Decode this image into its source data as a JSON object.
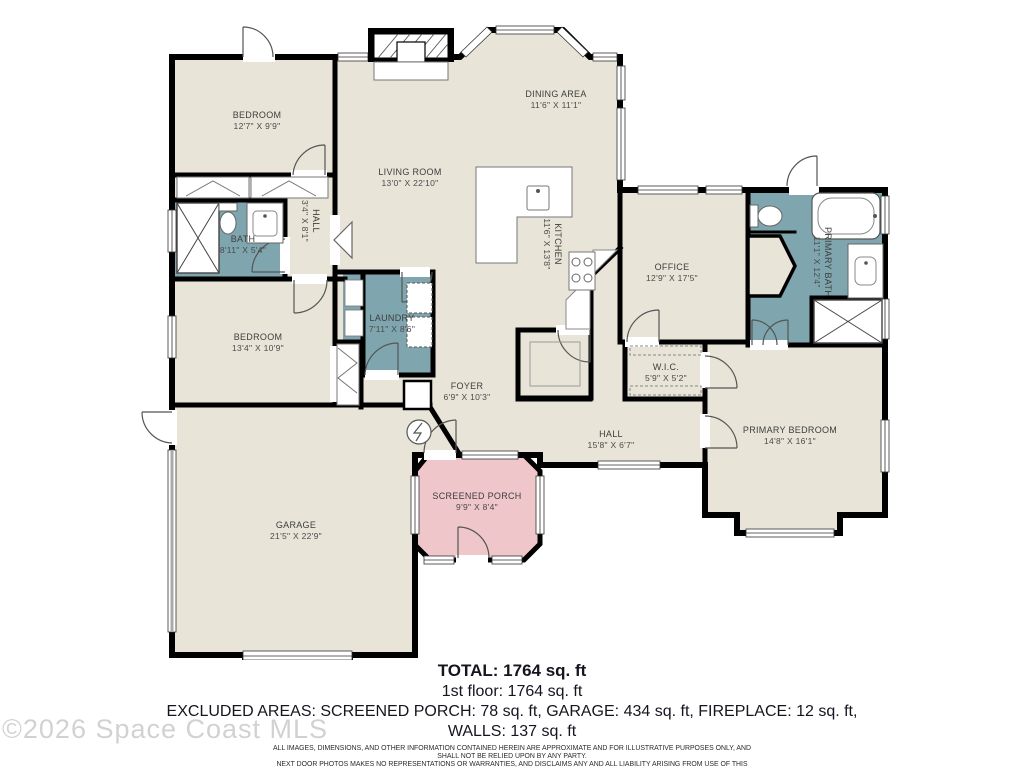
{
  "plan": {
    "colors": {
      "floor": "#e8e5d8",
      "wet_room": "#7fa6ae",
      "porch": "#efc6ca",
      "wall": "#000000",
      "label_text": "#3d3d3d"
    },
    "rooms": [
      {
        "name": "BEDROOM",
        "dims": "12'7\" X 9'9\""
      },
      {
        "name": "DINING AREA",
        "dims": "11'6\" X 11'1\""
      },
      {
        "name": "LIVING ROOM",
        "dims": "13'0\" X 22'10\""
      },
      {
        "name": "KITCHEN",
        "dims": "11'6\" X 13'8\""
      },
      {
        "name": "OFFICE",
        "dims": "12'9\" X 17'5\""
      },
      {
        "name": "PRIMARY BATH",
        "dims": "11'1\" X 12'4\""
      },
      {
        "name": "HALL",
        "dims": "3'4\" X 8'1\""
      },
      {
        "name": "BATH",
        "dims": "8'11\" X 5'4\""
      },
      {
        "name": "BEDROOM",
        "dims": "13'4\" X 10'9\""
      },
      {
        "name": "LAUNDRY",
        "dims": "7'11\" X 8'6\""
      },
      {
        "name": "FOYER",
        "dims": "6'9\" X 10'3\""
      },
      {
        "name": "W.I.C.",
        "dims": "5'9\" X 5'2\""
      },
      {
        "name": "HALL",
        "dims": "15'8\" X 6'7\""
      },
      {
        "name": "PRIMARY BEDROOM",
        "dims": "14'8\" X 16'1\""
      },
      {
        "name": "GARAGE",
        "dims": "21'5\" X 22'9\""
      },
      {
        "name": "SCREENED PORCH",
        "dims": "9'9\" X 8'4\""
      }
    ]
  },
  "summary": {
    "total_line": "TOTAL: 1764 sq. ft",
    "floor_line": "1st floor: 1764 sq. ft",
    "excluded_line": "EXCLUDED AREAS: SCREENED PORCH: 78 sq. ft, GARAGE: 434 sq. ft, FIREPLACE: 12 sq. ft,",
    "walls_line": "WALLS: 137 sq. ft",
    "disclaimer_lines": [
      "ALL IMAGES, DIMENSIONS, AND OTHER INFORMATION CONTAINED HEREIN ARE APPROXIMATE AND FOR ILLUSTRATIVE PURPOSES ONLY, AND SHALL NOT BE RELIED UPON BY ANY PARTY.",
      "NEXT DOOR PHOTOS MAKES NO REPRESENTATIONS OR WARRANTIES, AND DISCLAIMS ANY AND ALL LIABILITY ARISING FROM USE OF THIS INFORMATION. ALL INFORMATION HEREIN",
      "SHALL BE SUBJECT TO THE TERMS AND CONDITIONS FOUND AT NEXTDOORPHOTOS.COM/TC."
    ]
  },
  "watermark": "©2026 Space Coast MLS"
}
